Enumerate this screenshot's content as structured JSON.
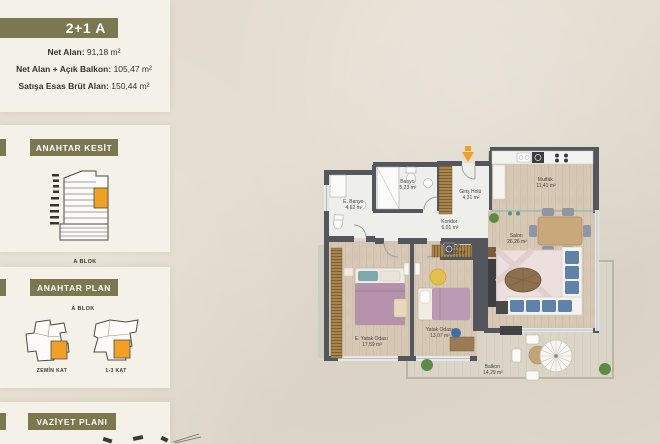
{
  "sidebar": {
    "unit_title": "2+1 A",
    "areas": [
      {
        "label": "Net Alan:",
        "value": "91,18 m²"
      },
      {
        "label": "Net Alan + Açık Balkon:",
        "value": "105,47 m²"
      },
      {
        "label": "Satışa Esas Brüt Alan:",
        "value": "150,44 m²"
      }
    ],
    "kesit": {
      "title": "ANAHTAR KESİT",
      "block_label": "A BLOK"
    },
    "plan": {
      "title": "ANAHTAR PLAN",
      "block_label": "A BLOK",
      "left_caption": "ZEMİN KAT",
      "right_caption": "1-3 KAT"
    },
    "vaziyet": {
      "title": "VAZİYET PLANI"
    }
  },
  "floorplan": {
    "entrance_icon": "entrance-arrow",
    "rooms": [
      {
        "name": "E. Banyo",
        "area": "4,62 m²"
      },
      {
        "name": "Banyo",
        "area": "5,23 m²"
      },
      {
        "name": "Giriş Holü",
        "area": "4,31 m²"
      },
      {
        "name": "Mutfak",
        "area": "11,41 m²"
      },
      {
        "name": "Koridor",
        "area": "6,01 m²"
      },
      {
        "name": "C.Ö.",
        "area": "1,05 m²"
      },
      {
        "name": "Salon",
        "area": "26,26 m²"
      },
      {
        "name": "E. Yatak Odası",
        "area": "17,59 m²"
      },
      {
        "name": "Yatak Odası",
        "area": "13,07 m²"
      },
      {
        "name": "Balkon",
        "area": "14,29 m²"
      }
    ]
  },
  "colors": {
    "olive": "#7b7850",
    "panel": "#f4f1e8",
    "background": "#e3dccf",
    "wall": "#53565c",
    "highlight_orange": "#f0a125",
    "wood_floor": "#d7c8b5",
    "tile_floor": "#eeeeeb"
  }
}
